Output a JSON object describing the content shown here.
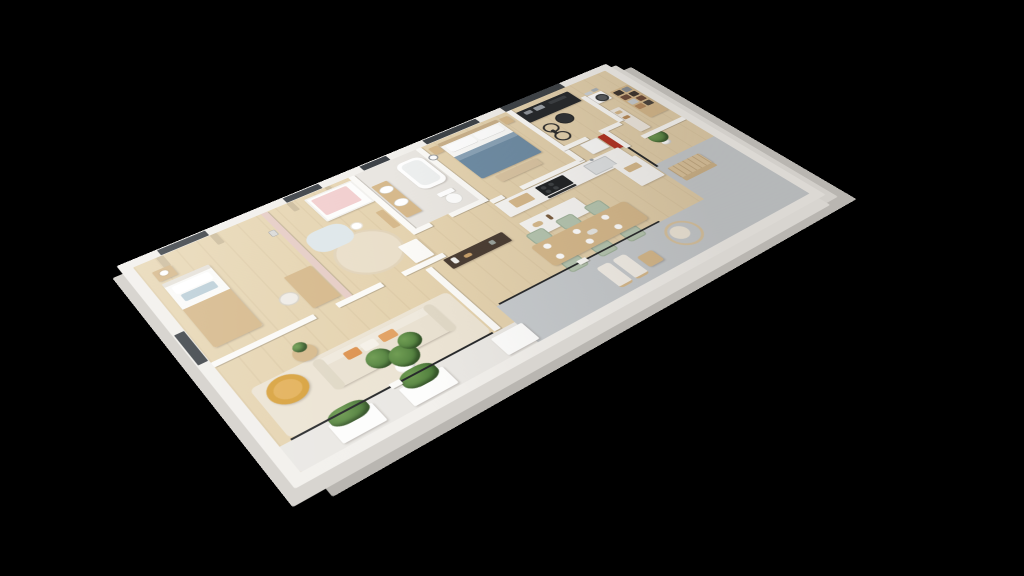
{
  "scene": {
    "description": "3D isometric cutaway floor plan of an apartment rendered on a black background",
    "view": "rotated dollhouse perspective, no text labels visible",
    "background": "#000000"
  },
  "colors": {
    "bg": "#000000",
    "slab": "#f2f0ec",
    "wall": "#fbfaf7",
    "floorWood": "#dfcba6",
    "rug": "#ece4d4",
    "terrace": "#c6cacd",
    "terraceWhite": "#eae8e4",
    "darkWall": "#3d4247",
    "furnWood": "#d6b98c",
    "bedBlue": "#6e8ca4",
    "sofaCream": "#e9e1d1",
    "pillowOrange": "#dd9350",
    "chairMustard": "#d8a23e",
    "chairSage": "#b5c5b0",
    "plantGreen": "#4e7c3c",
    "accentRed": "#b23222",
    "accentPink": "#e6cdc6",
    "bathTile": "#e9e6e1"
  },
  "rooms": [
    {
      "name": "bedroom",
      "furniture": [
        "single-bed",
        "nightstand-lamp",
        "desk",
        "desk-chair",
        "window-curtains"
      ]
    },
    {
      "name": "nursery",
      "furniture": [
        "crib",
        "round-rug",
        "play-mat",
        "dresser",
        "window-curtains"
      ]
    },
    {
      "name": "bathroom",
      "furniture": [
        "double-vanity",
        "bathtub",
        "toilet",
        "dark-door"
      ]
    },
    {
      "name": "master-bedroom",
      "furniture": [
        "double-bed-blue",
        "nightstands",
        "foot-bench",
        "wall-clock",
        "dark-window"
      ]
    },
    {
      "name": "office",
      "furniture": [
        "black-workstation-desk",
        "office-chair",
        "bicycle",
        "red-cabinet"
      ]
    },
    {
      "name": "pantry-laundry",
      "furniture": [
        "washing-machine",
        "cube-shelf",
        "counter",
        "storage-boxes"
      ]
    },
    {
      "name": "kitchen",
      "furniture": [
        "counter-run",
        "cooktop",
        "oven",
        "sink",
        "island",
        "fridge",
        "cutting-board"
      ]
    },
    {
      "name": "dining-room",
      "furniture": [
        "dining-table",
        "six-sage-chairs",
        "plates",
        "console-table"
      ]
    },
    {
      "name": "living-room",
      "furniture": [
        "cream-sofa",
        "orange-pillows",
        "mustard-armchair",
        "side-table",
        "area-rug",
        "fiddle-leaf-fig"
      ]
    },
    {
      "name": "terrace",
      "furniture": [
        "garden-bench",
        "hanging-egg-chair",
        "lounge-chairs",
        "coffee-table",
        "planter-boxes",
        "potted-plants",
        "glass-sliding-doors"
      ]
    }
  ]
}
